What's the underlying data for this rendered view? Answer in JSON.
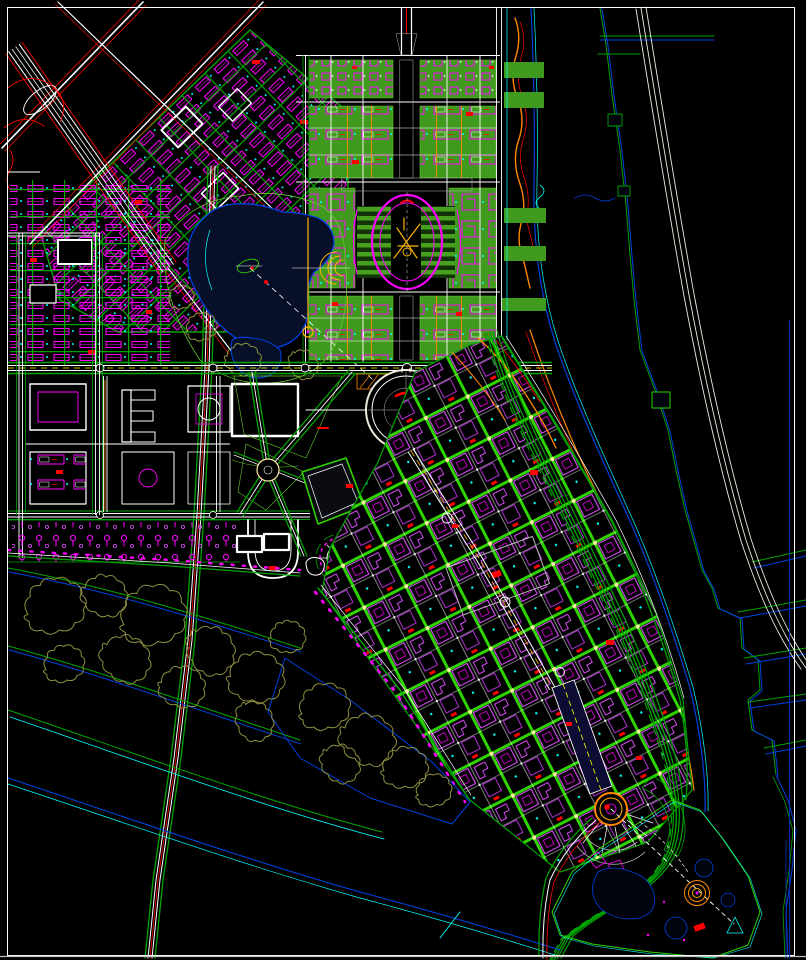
{
  "canvas": {
    "width": 806,
    "height": 960
  },
  "palette": {
    "bg": "#000000",
    "frame": "#ffffff",
    "frame_dim": "#bdbdbd",
    "magenta": "#ff00ff",
    "magenta_soft": "#e04cff",
    "purple": "#b12fd4",
    "street_green": "#00a400",
    "bright_green": "#2fd400",
    "lawn": "#3f9a1d",
    "lawn_edge": "#66c92e",
    "stipple": "#58b52c",
    "stipple2": "#8bd84a",
    "cyan": "#00ffff",
    "water_blue": "#0040e0",
    "deep_water": "#071028",
    "pond": "#01040c",
    "red": "#ff0000",
    "orange": "#ff8800",
    "amber": "#ffb300",
    "yellow": "#ffff00",
    "node_cream": "#ffe9a8",
    "gray": "#b8b8b8",
    "olive": "#8f9040",
    "cream": "#efeadc",
    "dark_block": "#0b0b12",
    "spine_navy": "#0d0d33"
  },
  "features": [
    {
      "id": "border-frame"
    },
    {
      "id": "river"
    },
    {
      "id": "far-bank"
    },
    {
      "id": "levee-road"
    },
    {
      "id": "upper-left-diagonal-roads"
    },
    {
      "id": "upper-left-rotated-district"
    },
    {
      "id": "left-district"
    },
    {
      "id": "axis-district"
    },
    {
      "id": "civic-oval"
    },
    {
      "id": "city-lake"
    },
    {
      "id": "lake-park"
    },
    {
      "id": "campus-district"
    },
    {
      "id": "central-roundabout"
    },
    {
      "id": "central-green-wedge"
    },
    {
      "id": "sun-plaza"
    },
    {
      "id": "lower-right-district"
    },
    {
      "id": "gray-plaza"
    },
    {
      "id": "waterfront-boulevard"
    },
    {
      "id": "southwest-channels"
    },
    {
      "id": "tree-groves"
    },
    {
      "id": "marina-circle-plaza"
    },
    {
      "id": "peninsula-park"
    }
  ]
}
